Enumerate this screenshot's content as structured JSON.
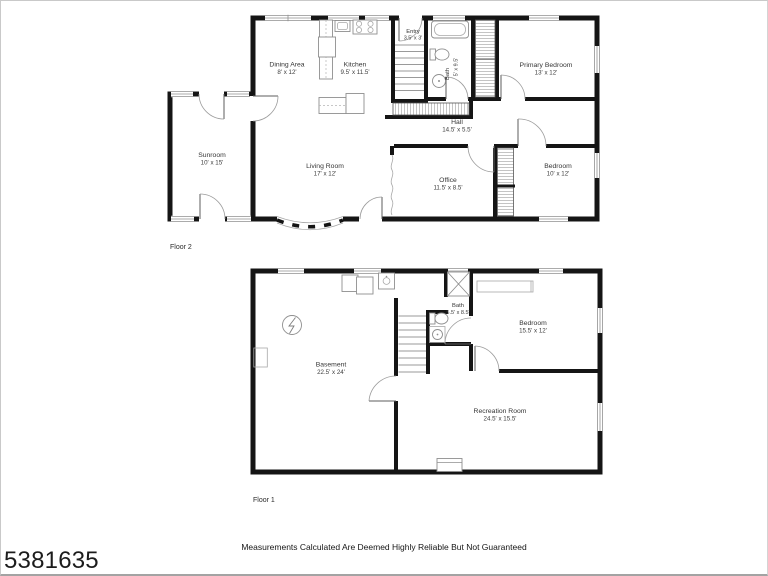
{
  "page": {
    "mls_number": "5381635",
    "disclaimer": "Measurements Calculated Are Deemed Highly Reliable But Not Guaranteed"
  },
  "floor2": {
    "label": "Floor 2",
    "rooms": {
      "dining": {
        "name": "Dining Area",
        "dims": "8' x 12'"
      },
      "kitchen": {
        "name": "Kitchen",
        "dims": "9.5' x 11.5'"
      },
      "entry": {
        "name": "Entry",
        "dims": "3.5' x 3'"
      },
      "bath": {
        "name": "Bath",
        "dims": "5' x 9.5'"
      },
      "primary": {
        "name": "Primary Bedroom",
        "dims": "13' x 12'"
      },
      "hall": {
        "name": "Hall",
        "dims": "14.5' x 5.5'"
      },
      "sunroom": {
        "name": "Sunroom",
        "dims": "10' x 15'"
      },
      "living": {
        "name": "Living Room",
        "dims": "17' x 12'"
      },
      "office": {
        "name": "Office",
        "dims": "11.5' x 8.5'"
      },
      "bedroom": {
        "name": "Bedroom",
        "dims": "10' x 12'"
      }
    }
  },
  "floor1": {
    "label": "Floor 1",
    "rooms": {
      "basement": {
        "name": "Basement",
        "dims": "22.5' x 24'"
      },
      "bath": {
        "name": "Bath",
        "dims": "5.5' x 8.5'"
      },
      "bedroom": {
        "name": "Bedroom",
        "dims": "15.5' x 12'"
      },
      "recreation": {
        "name": "Recreation Room",
        "dims": "24.5' x 15.5'"
      }
    }
  },
  "colors": {
    "wall": "#151515",
    "fixture": "#8f8f8f",
    "text": "#353535"
  }
}
